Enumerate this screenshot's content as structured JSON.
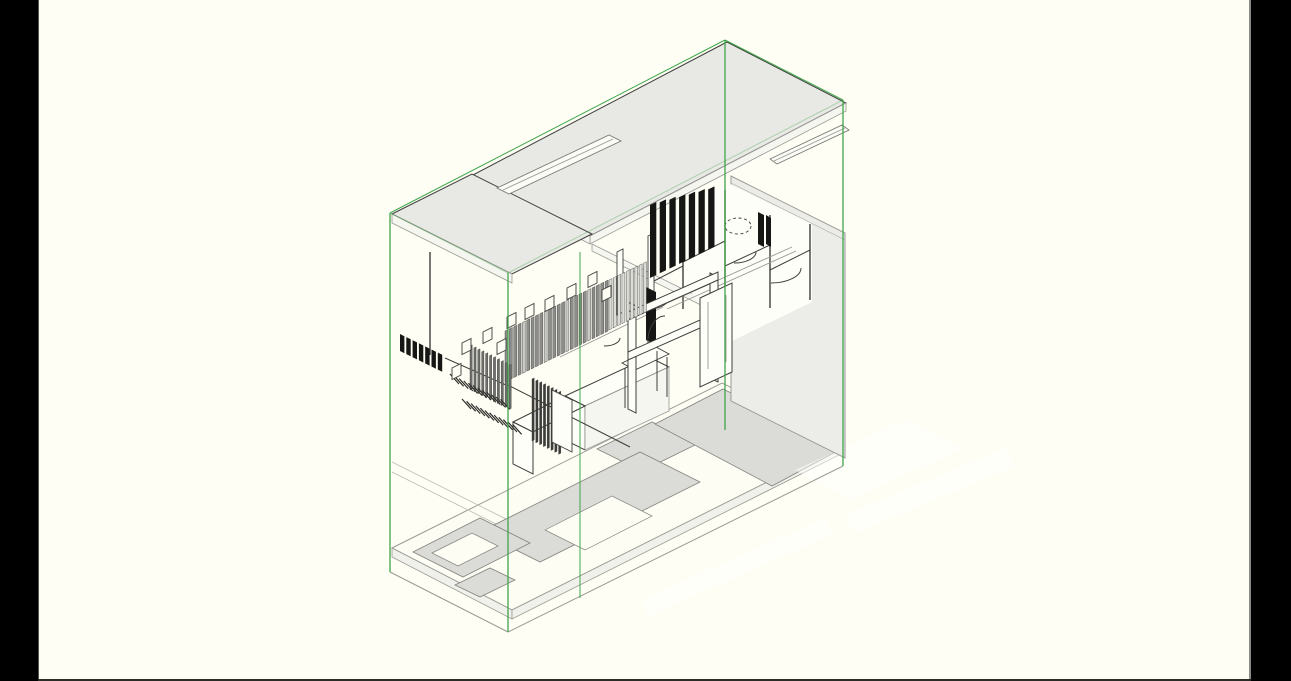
{
  "canvas": {
    "width": 1291,
    "height": 681
  },
  "letterbox": {
    "left_width": 38,
    "right_width": 40,
    "bottom_line_height": 2
  },
  "colors": {
    "letterbox": "#000000",
    "paper": "#FFFEF4",
    "roof": "#E8E8E4",
    "roof_fascia": "#F6F6F0",
    "wall_shadow": "#ECECE8",
    "floor_plate": "#DBDBD7",
    "slab_face": "#F1F1EB",
    "slab_white": "#FDFDF4",
    "white_fill": "#FEFEF8",
    "sky_fill": "#FCFCF6",
    "line": "#3E3E3C",
    "line_light": "#9A9A96",
    "section_box": "#3FA64B",
    "louver_gray": "#8D8D8B",
    "louver_light": "#C9C9C5",
    "louver_pale": "#DCDCD8",
    "screen_gray": "#6E6E6C",
    "screen_dark": "#3C3C3A",
    "louver_dark": "#161614",
    "hatch": "#2E2E2C",
    "watermark": "#FFFFFF"
  },
  "section_box": {
    "top_vertex": [
      725,
      40
    ],
    "left_edge": [
      390,
      213,
      390,
      572
    ],
    "front_edge": [
      508,
      273,
      508,
      632
    ],
    "back_edge": [
      725,
      40,
      725,
      430
    ],
    "right_edge": [
      843,
      100,
      843,
      466
    ],
    "extra_edge": [
      580,
      252,
      580,
      598
    ]
  },
  "generated": {
    "louver_band_a": {
      "x0": 505,
      "y0": 331,
      "count": 24,
      "dx": 4.35,
      "dy": -2.15,
      "w": 3,
      "h": 51,
      "light_every": 5
    },
    "louver_band_b": {
      "x0": 609,
      "y0": 280,
      "count": 9,
      "dx": 4.3,
      "dy": -2.1,
      "w": 3,
      "h": 50
    },
    "dark_louvers": {
      "x0": 650,
      "top0": 205,
      "dtop": -2.6,
      "bot0": 278,
      "dbot": -4.7,
      "dx": 9.7,
      "w": 6.3,
      "count": 7
    },
    "wall_slats": {
      "x0": 400,
      "y0": 334,
      "dx": 6.3,
      "dy": 3.1,
      "w": 4.4,
      "h": 17,
      "count": 7
    },
    "screen_1": {
      "x0": 470,
      "y0": 346,
      "dx": 3.9,
      "dy": 1.95,
      "w": 2.2,
      "h": 44,
      "count": 11
    },
    "screen_2": {
      "x0": 532,
      "y0": 379,
      "dx": 3.8,
      "dy": 1.9,
      "w": 2.2,
      "h": 62,
      "count": 8
    },
    "stair_hatch": [
      {
        "x0": 450,
        "y0": 374,
        "count": 12,
        "dx": 4.6,
        "dy": 2.3,
        "lx": 9,
        "ly": 10
      },
      {
        "x0": 462,
        "y0": 399,
        "count": 12,
        "dx": 4.6,
        "dy": 2.3,
        "lx": 9,
        "ly": 10
      }
    ],
    "window_squares": [
      [
        452,
        368
      ],
      [
        462,
        343
      ],
      [
        483,
        332
      ],
      [
        497,
        343
      ],
      [
        507,
        317
      ],
      [
        525,
        308
      ],
      [
        545,
        300
      ],
      [
        567,
        288
      ],
      [
        588,
        276
      ],
      [
        602,
        290
      ]
    ]
  }
}
